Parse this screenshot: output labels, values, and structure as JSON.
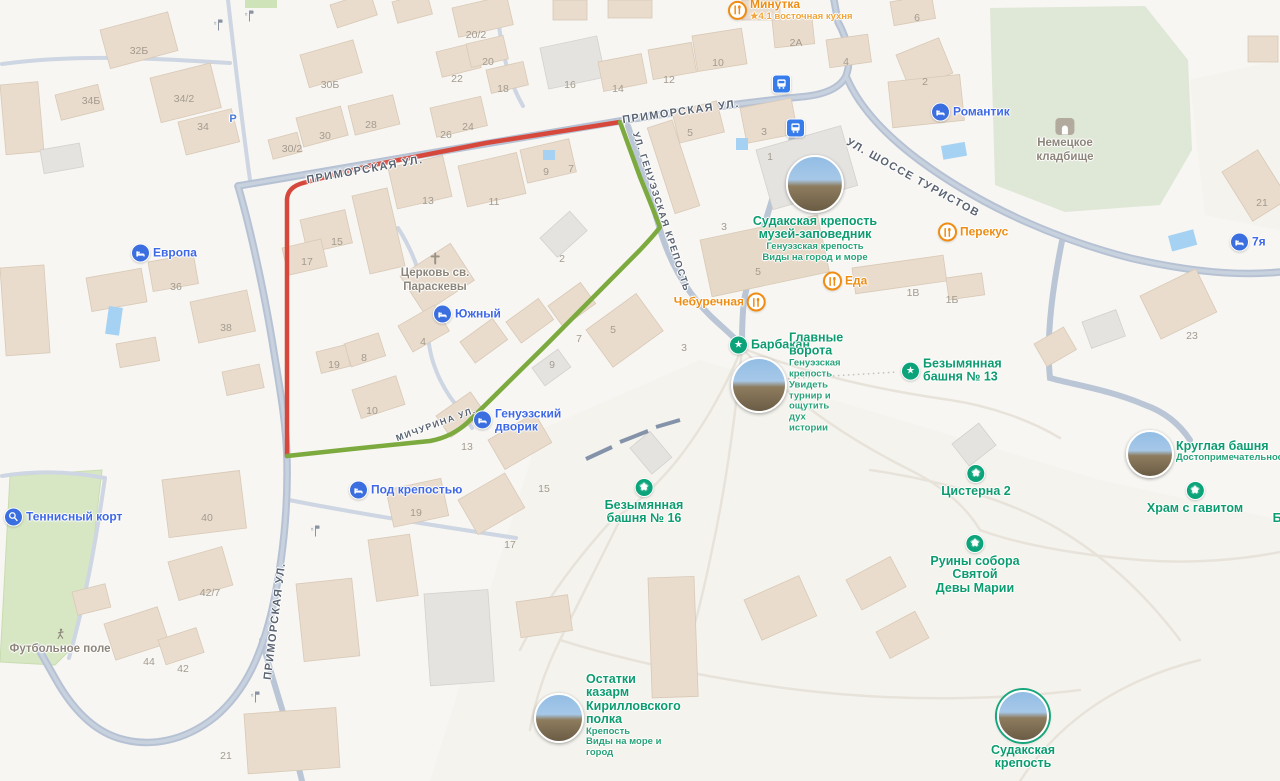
{
  "map": {
    "route": {
      "red_color": "#d6483c",
      "green_color": "#7caa3e"
    },
    "streets": [
      {
        "t": "ПРИМОРСКАЯ УЛ.",
        "x": 365,
        "y": 170,
        "r": -10,
        "s": 11
      },
      {
        "t": "ПРИМОРСКАЯ УЛ.",
        "x": 681,
        "y": 112,
        "r": -8,
        "s": 11
      },
      {
        "t": "УЛ. ШОССЕ ТУРИСТОВ",
        "x": 913,
        "y": 178,
        "r": 29,
        "s": 11
      },
      {
        "t": "УЛ. ГЕНУЭЗСКАЯ КРЕПОСТЬ",
        "x": 661,
        "y": 212,
        "r": 72,
        "s": 9.5
      },
      {
        "t": "ПРИМОРСКАЯ УЛ.",
        "x": 275,
        "y": 621,
        "r": -83,
        "s": 11
      },
      {
        "t": "МИЧУРИНА УЛ.",
        "x": 436,
        "y": 424,
        "r": -20,
        "s": 9
      }
    ],
    "house_numbers": [
      {
        "t": "32Б",
        "x": 139,
        "y": 51
      },
      {
        "t": "34Б",
        "x": 91,
        "y": 101
      },
      {
        "t": "34/2",
        "x": 184,
        "y": 99
      },
      {
        "t": "34",
        "x": 203,
        "y": 127
      },
      {
        "t": "30Б",
        "x": 330,
        "y": 85
      },
      {
        "t": "30",
        "x": 325,
        "y": 136
      },
      {
        "t": "30/2",
        "x": 292,
        "y": 149
      },
      {
        "t": "28",
        "x": 371,
        "y": 125
      },
      {
        "t": "26",
        "x": 446,
        "y": 135
      },
      {
        "t": "24",
        "x": 468,
        "y": 127
      },
      {
        "t": "22",
        "x": 457,
        "y": 79
      },
      {
        "t": "20/2",
        "x": 476,
        "y": 35
      },
      {
        "t": "20",
        "x": 488,
        "y": 62
      },
      {
        "t": "18",
        "x": 503,
        "y": 89
      },
      {
        "t": "16",
        "x": 570,
        "y": 85
      },
      {
        "t": "14",
        "x": 618,
        "y": 89
      },
      {
        "t": "12",
        "x": 669,
        "y": 80
      },
      {
        "t": "10",
        "x": 718,
        "y": 63
      },
      {
        "t": "2А",
        "x": 796,
        "y": 43
      },
      {
        "t": "4",
        "x": 846,
        "y": 62
      },
      {
        "t": "6",
        "x": 917,
        "y": 18
      },
      {
        "t": "2",
        "x": 925,
        "y": 82
      },
      {
        "t": "21",
        "x": 1262,
        "y": 203
      },
      {
        "t": "5",
        "x": 690,
        "y": 133
      },
      {
        "t": "3",
        "x": 764,
        "y": 132
      },
      {
        "t": "1",
        "x": 770,
        "y": 157
      },
      {
        "t": "13",
        "x": 428,
        "y": 201
      },
      {
        "t": "11",
        "x": 494,
        "y": 202
      },
      {
        "t": "9",
        "x": 546,
        "y": 172
      },
      {
        "t": "7",
        "x": 571,
        "y": 169
      },
      {
        "t": "15",
        "x": 337,
        "y": 242
      },
      {
        "t": "17",
        "x": 307,
        "y": 262
      },
      {
        "t": "2",
        "x": 562,
        "y": 259
      },
      {
        "t": "36",
        "x": 176,
        "y": 287
      },
      {
        "t": "38",
        "x": 226,
        "y": 328
      },
      {
        "t": "19",
        "x": 334,
        "y": 365
      },
      {
        "t": "8",
        "x": 364,
        "y": 358
      },
      {
        "t": "4",
        "x": 423,
        "y": 342
      },
      {
        "t": "5",
        "x": 613,
        "y": 330
      },
      {
        "t": "7",
        "x": 579,
        "y": 339
      },
      {
        "t": "9",
        "x": 552,
        "y": 365
      },
      {
        "t": "3",
        "x": 684,
        "y": 348
      },
      {
        "t": "3",
        "x": 724,
        "y": 227
      },
      {
        "t": "5",
        "x": 758,
        "y": 272
      },
      {
        "t": "1В",
        "x": 913,
        "y": 293
      },
      {
        "t": "1Б",
        "x": 952,
        "y": 300
      },
      {
        "t": "23",
        "x": 1192,
        "y": 336
      },
      {
        "t": "10",
        "x": 372,
        "y": 411
      },
      {
        "t": "13",
        "x": 467,
        "y": 447
      },
      {
        "t": "19",
        "x": 416,
        "y": 513
      },
      {
        "t": "15",
        "x": 544,
        "y": 489
      },
      {
        "t": "17",
        "x": 510,
        "y": 545
      },
      {
        "t": "40",
        "x": 207,
        "y": 518
      },
      {
        "t": "42/7",
        "x": 210,
        "y": 593
      },
      {
        "t": "44",
        "x": 149,
        "y": 662
      },
      {
        "t": "42",
        "x": 183,
        "y": 669
      },
      {
        "t": "21",
        "x": 226,
        "y": 756
      }
    ],
    "hotels": [
      {
        "id": "evropa",
        "lines": [
          "Европа"
        ],
        "x": 140,
        "y": 253,
        "side": "right"
      },
      {
        "id": "romantik",
        "lines": [
          "Романтик"
        ],
        "x": 940,
        "y": 112,
        "side": "right"
      },
      {
        "id": "yuzhny",
        "lines": [
          "Южный"
        ],
        "x": 442,
        "y": 314,
        "side": "right"
      },
      {
        "id": "genuezsky-dvorik",
        "lines": [
          "Генуэзский",
          "дворик"
        ],
        "x": 482,
        "y": 420,
        "side": "right"
      },
      {
        "id": "pod-krepostyu",
        "lines": [
          "Под крепостью"
        ],
        "x": 358,
        "y": 490,
        "side": "right"
      },
      {
        "id": "7ya",
        "lines": [
          "7я"
        ],
        "x": 1239,
        "y": 242,
        "side": "right"
      },
      {
        "id": "tennisny-kort",
        "lines": [
          "Теннисный корт"
        ],
        "x": 13,
        "y": 517,
        "side": "right",
        "icon": "tennis"
      }
    ],
    "food": [
      {
        "id": "minutka",
        "name": "Минутка",
        "sub": "★4.1 восточная кухня",
        "x": 737,
        "y": 10,
        "side": "right"
      },
      {
        "id": "eda",
        "name": "Еда",
        "x": 832,
        "y": 281,
        "side": "right"
      },
      {
        "id": "cheburechnaya",
        "name": "Чебуречная",
        "x": 757,
        "y": 302,
        "side": "left"
      },
      {
        "id": "perekus",
        "name": "Перекус",
        "x": 947,
        "y": 232,
        "side": "right"
      }
    ],
    "sights_star": [
      {
        "id": "barbakan",
        "lines": [
          "Барбакан"
        ],
        "x": 738,
        "y": 345,
        "side": "right"
      },
      {
        "id": "bezymyannaya-13",
        "lines": [
          "Безымянная",
          "башня № 13"
        ],
        "x": 910,
        "y": 371,
        "side": "right"
      },
      {
        "id": "bezymyannaya-16",
        "lines": [
          "Безымянная",
          "башня № 16"
        ],
        "x": 644,
        "y": 487,
        "side": "below"
      },
      {
        "id": "cisterna-2",
        "lines": [
          "Цистерна 2"
        ],
        "x": 976,
        "y": 473,
        "side": "below"
      },
      {
        "id": "hram-s-gavitom",
        "lines": [
          "Храм с гавитом"
        ],
        "x": 1195,
        "y": 490,
        "side": "below"
      },
      {
        "id": "ruiny-sobora",
        "lines": [
          "Руины собора",
          "Святой",
          "Девы Марии"
        ],
        "x": 975,
        "y": 543,
        "side": "below"
      },
      {
        "id": "bezymyannaya-edge",
        "lines": [
          "Безымянная",
          "башня"
        ],
        "x": 1312,
        "y": 500,
        "side": "below"
      }
    ],
    "sights_photo": [
      {
        "id": "sudakskaya-krepost-muzey",
        "title": [
          "Судакская крепость",
          "музей-заповедник"
        ],
        "sub": [
          "Генуэзская крепость",
          "Виды на город и море"
        ],
        "x": 815,
        "y": 182,
        "r": 27,
        "layout": "below"
      },
      {
        "id": "glavnye-vorota",
        "title": [
          "Главные ворота"
        ],
        "sub": [
          "Генуэзская крепость",
          "Увидеть турнир и",
          "ощутить дух истории"
        ],
        "x": 757,
        "y": 383,
        "r": 26,
        "layout": "right"
      },
      {
        "id": "kruglaya-bashnya",
        "title": [
          "Круглая башня"
        ],
        "sub": [
          "Достопримечательность"
        ],
        "x": 1148,
        "y": 452,
        "r": 22,
        "layout": "right"
      },
      {
        "id": "ostatki-kazarm",
        "title": [
          "Остатки казарм",
          "Кирилловского полка"
        ],
        "sub": [
          "Крепость",
          "Виды на море и город"
        ],
        "x": 557,
        "y": 716,
        "r": 23,
        "layout": "right"
      },
      {
        "id": "sudakskaya-krepost",
        "title": [
          "Судакская",
          "крепость"
        ],
        "sub": [],
        "x": 1023,
        "y": 714,
        "r": 24,
        "layout": "below",
        "ring": true
      }
    ],
    "church": {
      "lines": [
        "Церковь св.",
        "Параскевы"
      ],
      "x": 435,
      "y": 252
    },
    "cemetery": {
      "lines": [
        "Немецкое",
        "кладбище"
      ],
      "x": 1065,
      "y": 118
    },
    "football": {
      "lines": [
        "Футбольное поле"
      ],
      "x": 60,
      "y": 628
    },
    "transit": [
      {
        "x": 781,
        "y": 84
      },
      {
        "x": 795,
        "y": 128
      }
    ],
    "bus_stops": [
      {
        "x": 219,
        "y": 25
      },
      {
        "x": 250,
        "y": 16
      },
      {
        "x": 316,
        "y": 531
      },
      {
        "x": 256,
        "y": 697
      }
    ],
    "parking": [
      {
        "t": "Р",
        "x": 233,
        "y": 119
      }
    ]
  }
}
